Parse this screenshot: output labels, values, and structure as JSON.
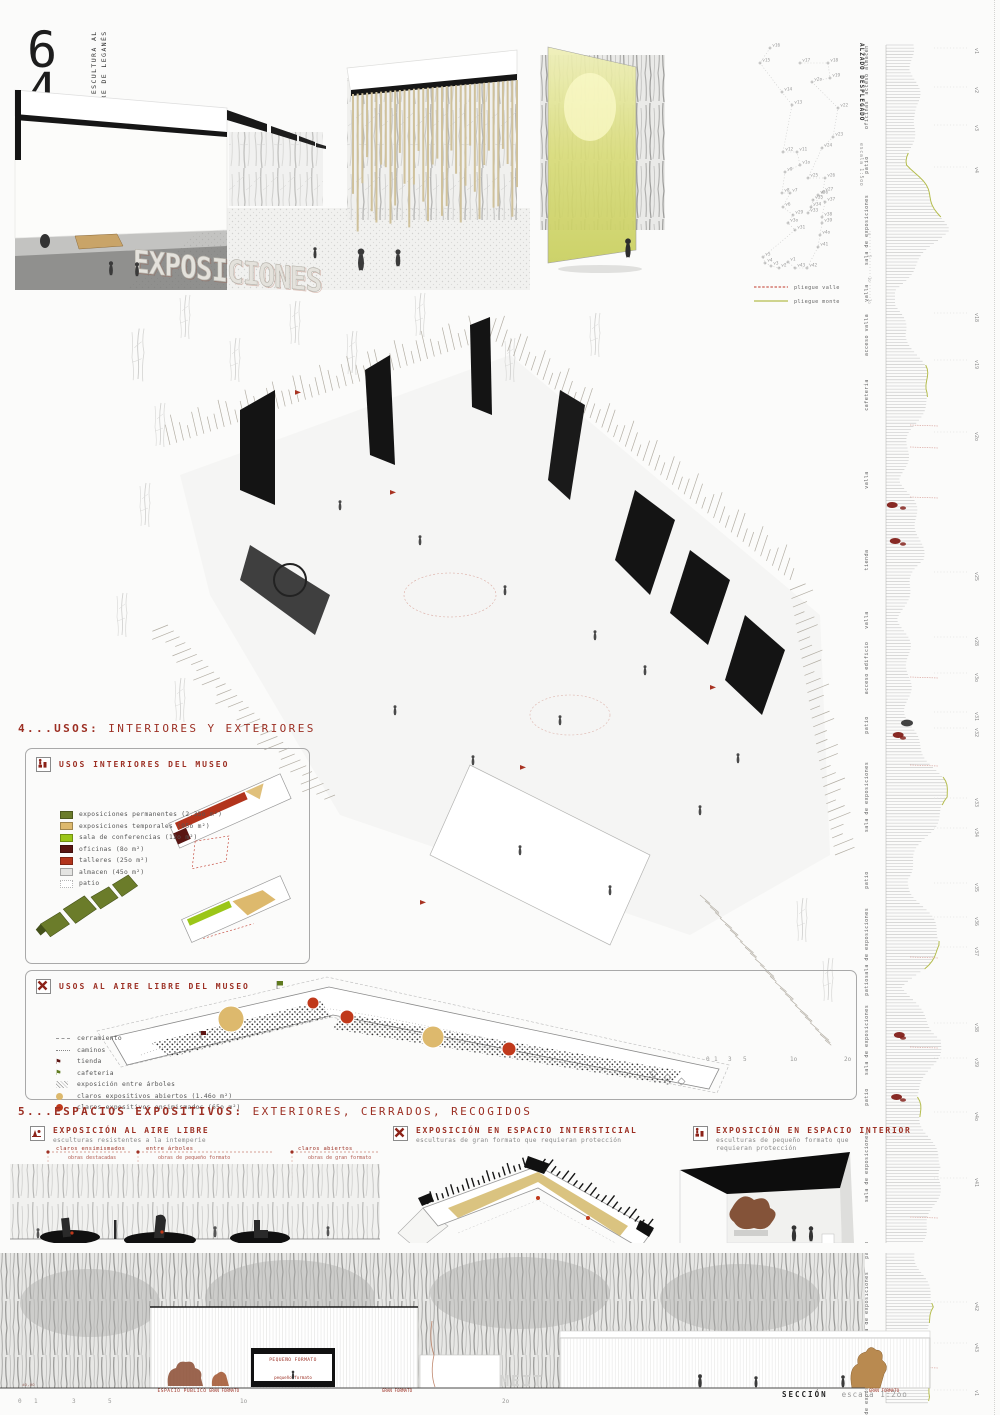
{
  "header": {
    "number_6": "6",
    "number_4": "4",
    "number_3": "3",
    "title_line1": "MUSEO DE ESCULTURA AL",
    "title_line2": "AIRE LIBRE DE LEGANÉS"
  },
  "hero": {
    "wall_text": "EXPOSICIONES"
  },
  "vertex_diagram": {
    "legend": [
      {
        "label": "pliegue valle",
        "color": "#c0392b",
        "style": "dashed"
      },
      {
        "label": "pliegue monte",
        "color": "#b5bd4e",
        "style": "solid"
      }
    ],
    "vertices": [
      {
        "id": "v16",
        "x": 22,
        "y": 13
      },
      {
        "id": "v15",
        "x": 12,
        "y": 28
      },
      {
        "id": "v14",
        "x": 34,
        "y": 57
      },
      {
        "id": "v13",
        "x": 44,
        "y": 70
      },
      {
        "id": "v12",
        "x": 35,
        "y": 117
      },
      {
        "id": "v11",
        "x": 49,
        "y": 117
      },
      {
        "id": "v1o",
        "x": 52,
        "y": 130
      },
      {
        "id": "v9",
        "x": 37,
        "y": 137
      },
      {
        "id": "v8",
        "x": 34,
        "y": 158
      },
      {
        "id": "v7",
        "x": 42,
        "y": 158
      },
      {
        "id": "v6",
        "x": 35,
        "y": 172
      },
      {
        "id": "v29",
        "x": 45,
        "y": 180
      },
      {
        "id": "v3o",
        "x": 40,
        "y": 188
      },
      {
        "id": "v31",
        "x": 47,
        "y": 195
      },
      {
        "id": "v5",
        "x": 15,
        "y": 222
      },
      {
        "id": "v4",
        "x": 17,
        "y": 228
      },
      {
        "id": "v3",
        "x": 23,
        "y": 231
      },
      {
        "id": "v2",
        "x": 31,
        "y": 233
      },
      {
        "id": "v1",
        "x": 40,
        "y": 227
      },
      {
        "id": "v43",
        "x": 47,
        "y": 233
      },
      {
        "id": "v42",
        "x": 59,
        "y": 233
      },
      {
        "id": "v41",
        "x": 70,
        "y": 212
      },
      {
        "id": "v4o",
        "x": 72,
        "y": 200
      },
      {
        "id": "v39",
        "x": 74,
        "y": 188
      },
      {
        "id": "v38",
        "x": 74,
        "y": 182
      },
      {
        "id": "v37",
        "x": 77,
        "y": 167
      },
      {
        "id": "v36",
        "x": 70,
        "y": 160
      },
      {
        "id": "v35",
        "x": 65,
        "y": 165
      },
      {
        "id": "v34",
        "x": 63,
        "y": 172
      },
      {
        "id": "v33",
        "x": 60,
        "y": 178
      },
      {
        "id": "v27",
        "x": 75,
        "y": 157
      },
      {
        "id": "v26",
        "x": 77,
        "y": 143
      },
      {
        "id": "v25",
        "x": 60,
        "y": 143
      },
      {
        "id": "v24",
        "x": 74,
        "y": 113
      },
      {
        "id": "v23",
        "x": 85,
        "y": 102
      },
      {
        "id": "v22",
        "x": 90,
        "y": 73
      },
      {
        "id": "v2o",
        "x": 64,
        "y": 47
      },
      {
        "id": "v19",
        "x": 82,
        "y": 43
      },
      {
        "id": "v18",
        "x": 80,
        "y": 28
      },
      {
        "id": "v17",
        "x": 52,
        "y": 28
      }
    ]
  },
  "unfolded_elevation": {
    "title": "ALZADO DESPLEGADO",
    "scale": "escala 1:5oo",
    "scale_ticks": [
      "o",
      "5",
      "1o",
      "2o"
    ],
    "segments": [
      {
        "label": "acceso almacén",
        "y": 35,
        "w": 22
      },
      {
        "label": "oficinas",
        "y": 80,
        "w": 34
      },
      {
        "label": "patio",
        "y": 130,
        "w": 26
      },
      {
        "label": "sala de exposiciones",
        "y": 195,
        "w": 56
      },
      {
        "label": "valla",
        "y": 258,
        "w": 14
      },
      {
        "label": "acceso valla",
        "y": 300,
        "w": 18
      },
      {
        "label": "cafetería",
        "y": 360,
        "w": 44
      },
      {
        "label": "valla",
        "y": 445,
        "w": 14
      },
      {
        "label": "tienda",
        "y": 525,
        "w": 40
      },
      {
        "label": "valla",
        "y": 585,
        "w": 13
      },
      {
        "label": "acceso edificio",
        "y": 633,
        "w": 20
      },
      {
        "label": "patio",
        "y": 690,
        "w": 28
      },
      {
        "label": "sala de exposiciones",
        "y": 762,
        "w": 58
      },
      {
        "label": "patio",
        "y": 845,
        "w": 24
      },
      {
        "label": "sala de exposiciones",
        "y": 908,
        "w": 52
      },
      {
        "label": "patio",
        "y": 952,
        "w": 22
      },
      {
        "label": "sala de exposiciones",
        "y": 1005,
        "w": 58
      },
      {
        "label": "patio",
        "y": 1062,
        "w": 24
      },
      {
        "label": "sala de exposiciones",
        "y": 1132,
        "w": 62
      },
      {
        "label": "patio",
        "y": 1215,
        "w": 26
      },
      {
        "label": "sala de exposiciones",
        "y": 1272,
        "w": 55
      },
      {
        "label": "patio",
        "y": 1322,
        "w": 20
      },
      {
        "label": "sala de exposiciones",
        "y": 1362,
        "w": 44
      }
    ],
    "vlabels": [
      {
        "id": "v1",
        "y": 13
      },
      {
        "id": "v2",
        "y": 52
      },
      {
        "id": "v3",
        "y": 90
      },
      {
        "id": "v4",
        "y": 132
      },
      {
        "id": "v18",
        "y": 278
      },
      {
        "id": "v19",
        "y": 325
      },
      {
        "id": "v2o",
        "y": 397
      },
      {
        "id": "v25",
        "y": 537
      },
      {
        "id": "v28",
        "y": 602
      },
      {
        "id": "v3o",
        "y": 638
      },
      {
        "id": "v31",
        "y": 677
      },
      {
        "id": "v32",
        "y": 693
      },
      {
        "id": "v33",
        "y": 763
      },
      {
        "id": "v34",
        "y": 793
      },
      {
        "id": "v35",
        "y": 848
      },
      {
        "id": "v36",
        "y": 882
      },
      {
        "id": "v37",
        "y": 912
      },
      {
        "id": "v38",
        "y": 988
      },
      {
        "id": "v39",
        "y": 1023
      },
      {
        "id": "v4o",
        "y": 1077
      },
      {
        "id": "v41",
        "y": 1143
      },
      {
        "id": "v42",
        "y": 1267
      },
      {
        "id": "v43",
        "y": 1308
      },
      {
        "id": "v1",
        "y": 1355
      }
    ]
  },
  "section4": {
    "heading_bold": "4...USOS:",
    "heading_rest": "INTERIORES Y EXTERIORES",
    "interior": {
      "title": "USOS INTERIORES DEL MUSEO",
      "items": [
        {
          "label": "exposiciones permanentes (2.35o m²)",
          "color": "#6b7c2a"
        },
        {
          "label": "exposiciones temporales (95o m²)",
          "color": "#ddb96d"
        },
        {
          "label": "sala de conferencias (12o m²)",
          "color": "#9bc618"
        },
        {
          "label": "oficinas (8o m²)",
          "color": "#591512"
        },
        {
          "label": "talleres (25o m²)",
          "color": "#b2341c"
        },
        {
          "label": "almacen (45o m²)",
          "color": "#e4e4e2"
        },
        {
          "label": "patio",
          "color": "#ffffff"
        }
      ]
    },
    "exterior": {
      "title": "USOS AL AIRE LIBRE DEL MUSEO",
      "items": [
        {
          "label": "cerramiento",
          "type": "dash"
        },
        {
          "label": "caminos",
          "type": "dots"
        },
        {
          "label": "tienda",
          "type": "flag-darkred",
          "color": "#5d1412"
        },
        {
          "label": "cafeteria",
          "type": "flag-green",
          "color": "#5f7a1e"
        },
        {
          "label": "exposición entre árboles",
          "type": "hatch"
        },
        {
          "label": "claros expositivos abiertos (1.46o m²)",
          "type": "circle",
          "color": "#ddb96d"
        },
        {
          "label": "claros expositivos ensimismados (65o m²)",
          "type": "circle",
          "color": "#c0391b"
        }
      ]
    }
  },
  "section5": {
    "heading_bold": "5...ESPACIOS EXPOSITIVOS:",
    "heading_rest": "EXTERIORES, CERRADOS, RECOGIDOS",
    "sub1": {
      "title": "EXPOSICIÓN AL AIRE LIBRE",
      "subtitle": "esculturas resistentes a la intemperie",
      "ann1a": "claros ensimismados",
      "ann1b": "obras destacadas",
      "ann2a": "entre árboles",
      "ann2b": "obras de pequeño formato",
      "ann3a": "claros abiertos",
      "ann3b": "obras de gran formato"
    },
    "sub2": {
      "title": "EXPOSICIÓN EN ESPACIO INTERSTICIAL",
      "subtitle": "esculturas de gran formato que requieran protección"
    },
    "sub3": {
      "title": "EXPOSICIÓN EN ESPACIO INTERIOR",
      "subtitle": "esculturas de pequeño formato que requieran protección"
    }
  },
  "axon": {
    "scalebar": [
      "0",
      "1",
      "3",
      "5",
      "1o",
      "2o"
    ]
  },
  "bottom": {
    "elev_mark": "±o,oo",
    "espacio_publico": "ESPACIO PÚBLICO",
    "gran_formato_left": "GRAN FORMATO",
    "pequeno_formato_upper": "PEQUEÑO FORMATO",
    "pequeno_formato_lower": "pequeño formato",
    "gran_formato_mid": "GRAN FORMATO",
    "gran_formato_right": "GRAN FORMATO",
    "signage": "MEIT",
    "section_label": "SECCIÓN",
    "section_scale": "escala 1:2oo",
    "scalebar": [
      "0",
      "1",
      "3",
      "5",
      "1o",
      "2o"
    ]
  }
}
